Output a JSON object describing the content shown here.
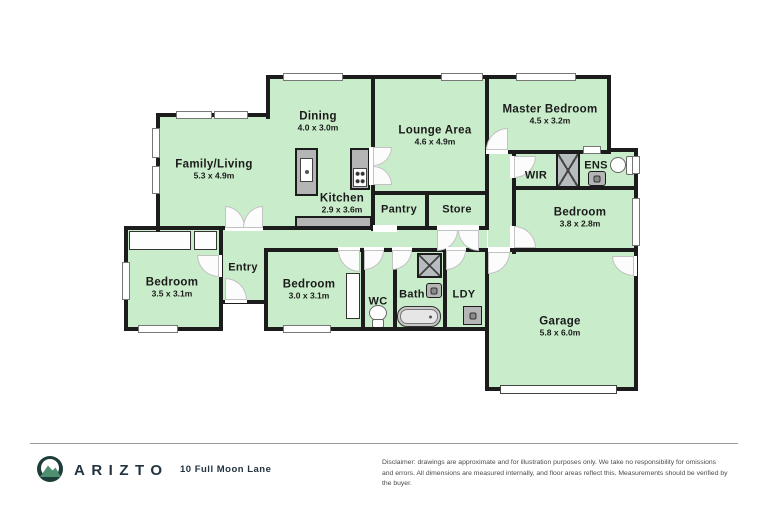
{
  "plan": {
    "rooms": [
      {
        "name": "Family/Living",
        "dims": "5.3 x 4.9m"
      },
      {
        "name": "Dining",
        "dims": "4.0 x 3.0m"
      },
      {
        "name": "Kitchen",
        "dims": "2.9 x 3.6m"
      },
      {
        "name": "Lounge Area",
        "dims": "4.6 x 4.9m"
      },
      {
        "name": "Master Bedroom",
        "dims": "4.5 x 3.2m"
      },
      {
        "name": "Bedroom",
        "dims": "3.8 x 2.8m"
      },
      {
        "name": "Bedroom",
        "dims": "3.5 x 3.1m"
      },
      {
        "name": "Bedroom",
        "dims": "3.0 x 3.1m"
      },
      {
        "name": "Garage",
        "dims": "5.8 x 6.0m"
      }
    ],
    "small_rooms": [
      {
        "name": "Entry"
      },
      {
        "name": "Pantry"
      },
      {
        "name": "Store"
      },
      {
        "name": "WIR"
      },
      {
        "name": "ENS"
      },
      {
        "name": "WC"
      },
      {
        "name": "Bath"
      },
      {
        "name": "LDY"
      }
    ]
  },
  "footer": {
    "brand": "ARIZTO",
    "address": "10 Full Moon Lane",
    "disclaimer": "Disclaimer: drawings are approximate and for illustration purposes only. We take no responsibility for omissions and errors. All dimensions are measured internally, and floor areas reflect this. Measurements should be verified by the buyer."
  },
  "colors": {
    "floor": "#c9ecca",
    "wall": "#1c1c1c",
    "brand_navy": "#22333f",
    "logo_teal": "#1d3d38",
    "logo_green": "#4d8f70"
  }
}
